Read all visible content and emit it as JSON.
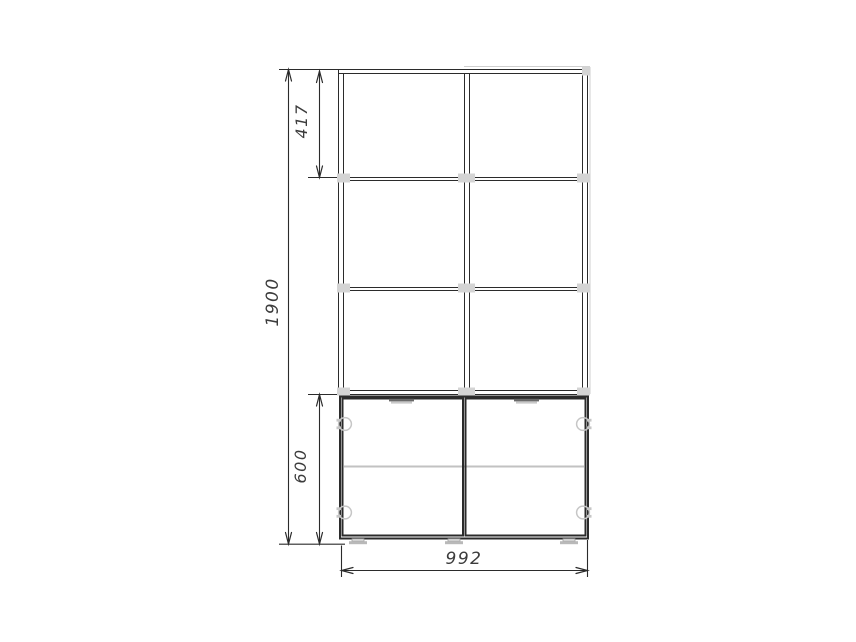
{
  "drawing": {
    "background": "#ffffff",
    "stroke_color": "#2b2b2b",
    "hardware_color": "#c6c6c6",
    "text_color": "#3c3c3c",
    "dimensions": {
      "height_total": "1900",
      "height_top_compartment": "417",
      "height_base_cabinet": "600",
      "width_overall": "992"
    },
    "components": {
      "shelf_columns": 2,
      "shelf_rows_per_column": 3,
      "doors": 2,
      "hinges_per_door": 2,
      "door_handles": 2,
      "feet": 3
    }
  }
}
